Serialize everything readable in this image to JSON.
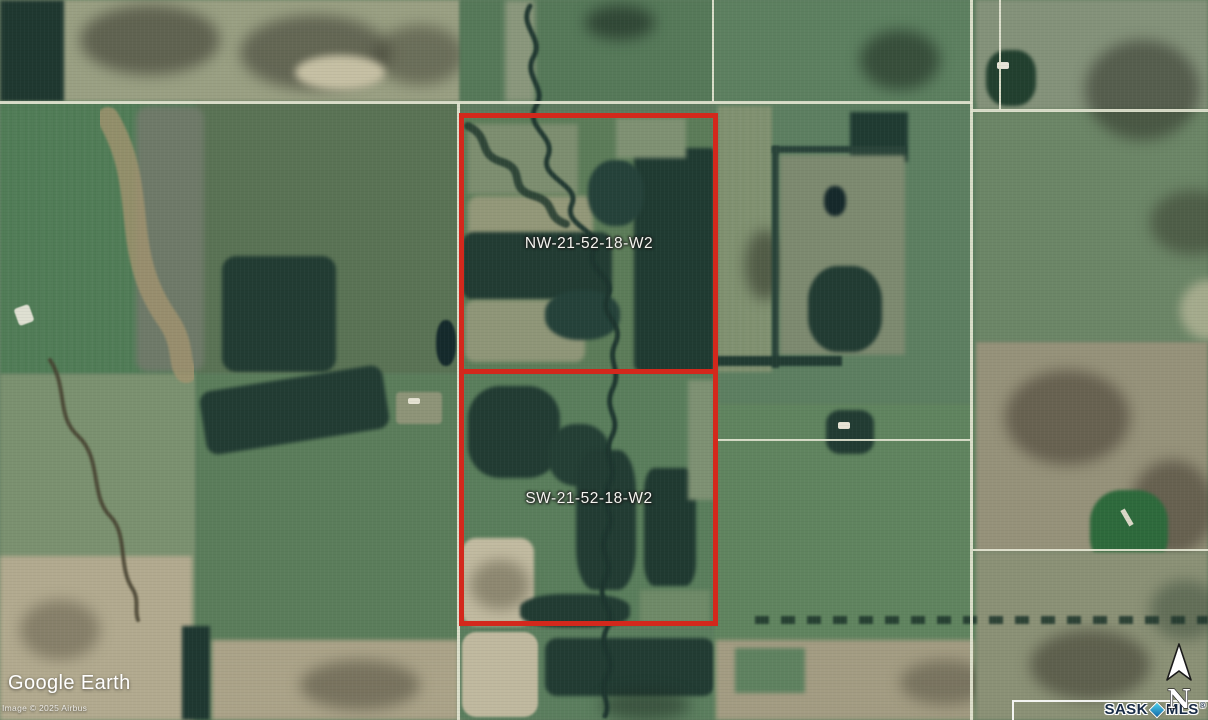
{
  "map": {
    "provider_logo": "Google Earth",
    "attribution": "Image © 2025 Airbus",
    "parcels": [
      {
        "label": "NW-21-52-18-W2"
      },
      {
        "label": "SW-21-52-18-W2"
      }
    ],
    "colors": {
      "boundary_red": "#d3281c",
      "brand_navy": "#182b45",
      "diamond_teal": "#38c6e3"
    }
  },
  "overlay": {
    "compass_label": "N",
    "brand": {
      "sask": "SASK",
      "mls": "MLS",
      "registered": "®"
    }
  }
}
